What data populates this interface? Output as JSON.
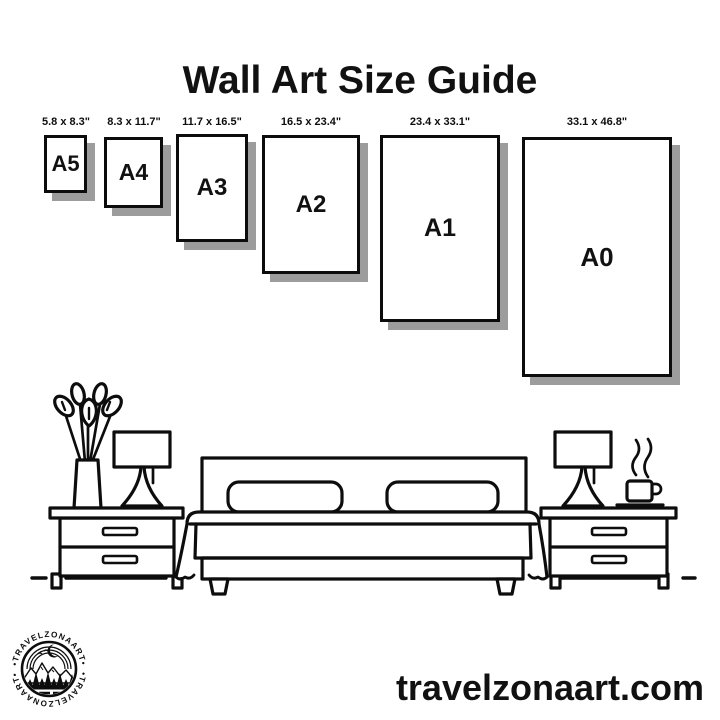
{
  "title": "Wall Art Size Guide",
  "sizes": [
    {
      "label": "A5",
      "dims": "5.8 x 8.3\""
    },
    {
      "label": "A4",
      "dims": "8.3 x 11.7\""
    },
    {
      "label": "A3",
      "dims": "11.7 x 16.5\""
    },
    {
      "label": "A2",
      "dims": "16.5 x 23.4\""
    },
    {
      "label": "A1",
      "dims": "23.4 x 33.1\""
    },
    {
      "label": "A0",
      "dims": "33.1 x 46.8\""
    }
  ],
  "logo": {
    "arc_text_top": "•TRAVELZONAART•",
    "arc_text_bottom": "•TRAVELZONAART•"
  },
  "website": "travelzonaart.com",
  "colors": {
    "ink": "#0d0d0d",
    "shadow": "#9c9c9c",
    "background": "#ffffff"
  },
  "illustration": {
    "items": [
      "plant-vase",
      "lamp-left",
      "nightstand-left",
      "bed-with-pillows",
      "nightstand-right",
      "lamp-right",
      "coffee-cup-with-steam",
      "floor-line"
    ]
  }
}
